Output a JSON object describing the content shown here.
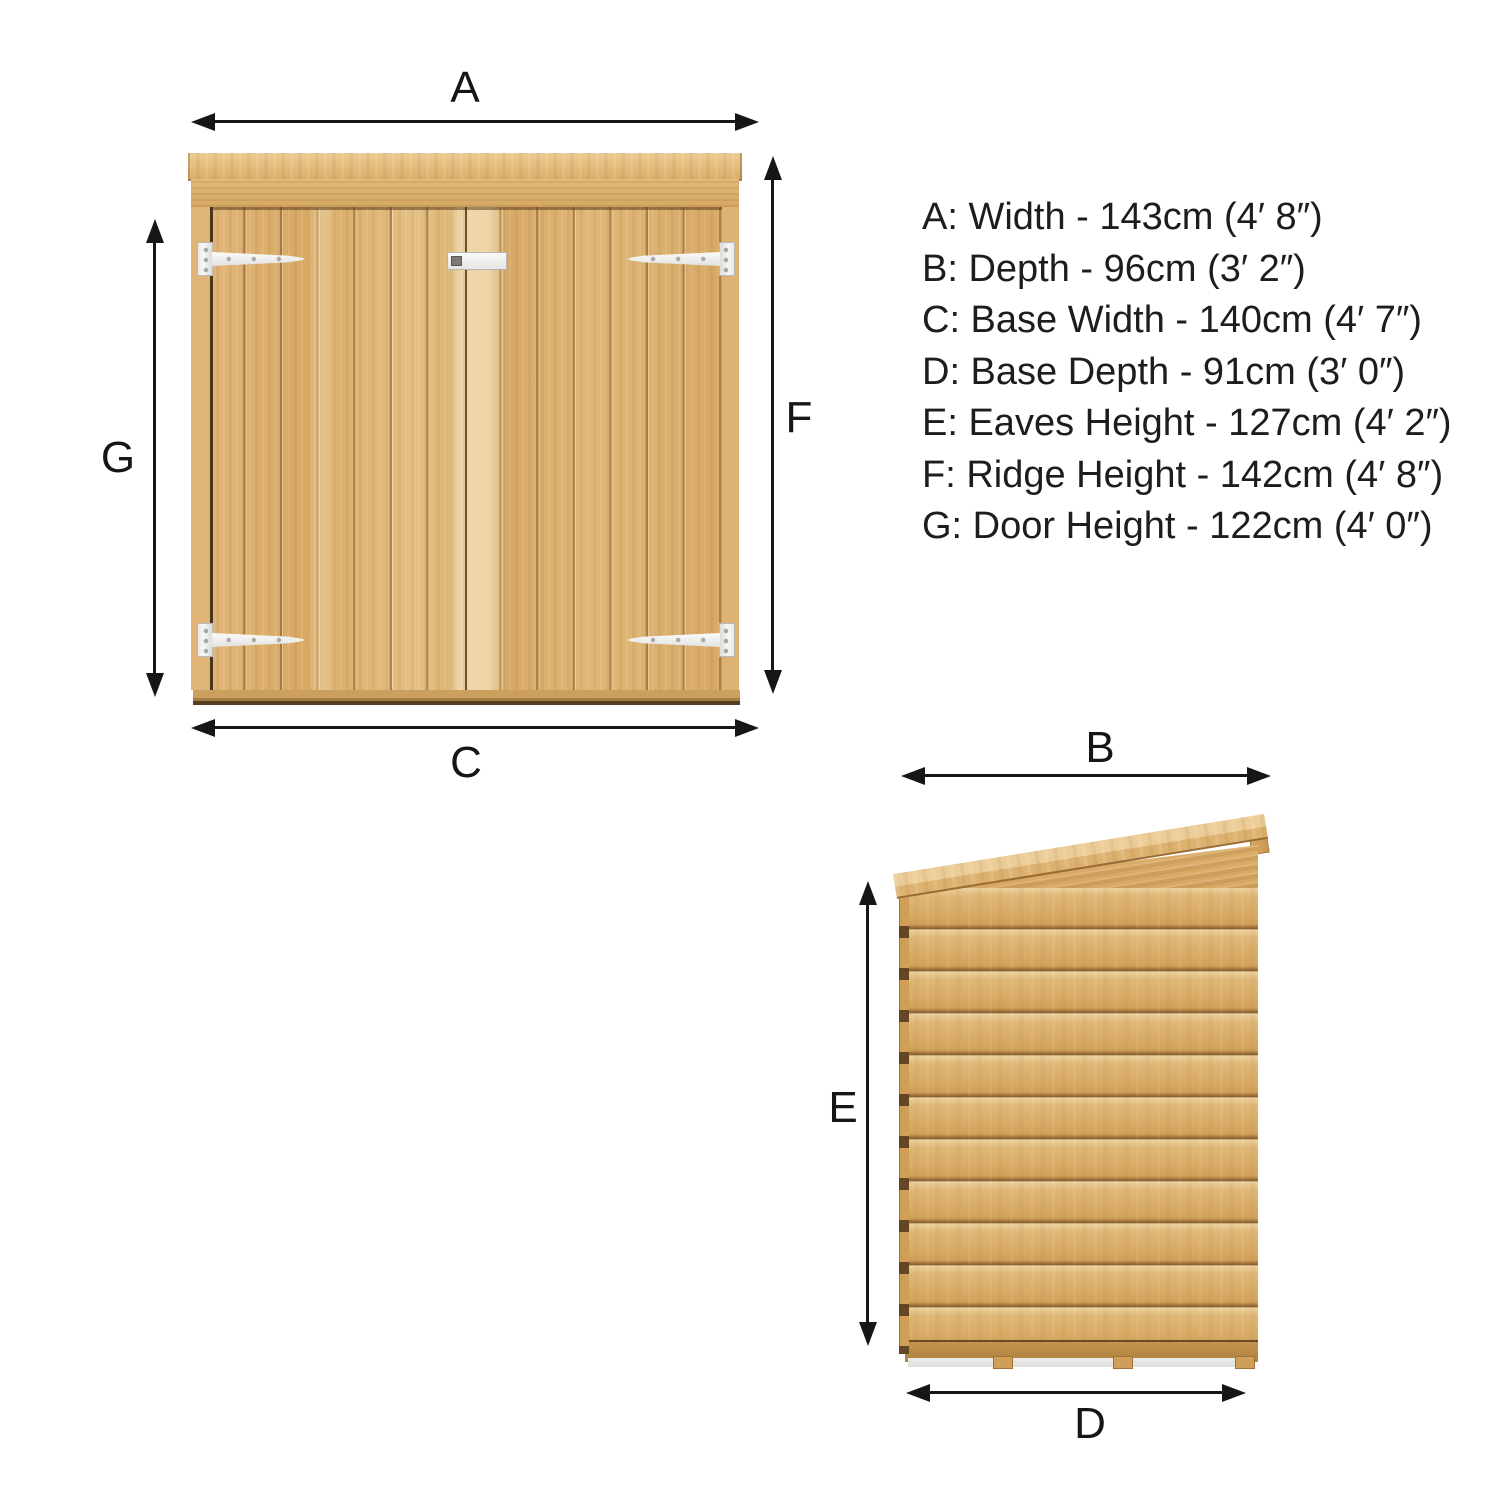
{
  "front_view": {
    "dims": {
      "top": "A",
      "left": "G",
      "right": "F",
      "bottom": "C"
    }
  },
  "side_view": {
    "dims": {
      "top": "B",
      "left": "E",
      "bottom": "D"
    }
  },
  "specs": [
    {
      "id": "A",
      "text": "A: Width - 143cm (4′ 8″)"
    },
    {
      "id": "B",
      "text": "B: Depth - 96cm (3′ 2″)"
    },
    {
      "id": "C",
      "text": "C: Base Width - 140cm (4′ 7″)"
    },
    {
      "id": "D",
      "text": "D: Base Depth - 91cm (3′ 0″)"
    },
    {
      "id": "E",
      "text": "E: Eaves Height - 127cm (4′ 2″)"
    },
    {
      "id": "F",
      "text": "F: Ridge Height - 142cm (4′ 8″)"
    },
    {
      "id": "G",
      "text": "G: Door Height - 122cm (4′ 0″)"
    }
  ],
  "colors": {
    "arrow": "#161616",
    "text": "#1d1d1b",
    "wood_light": "#ecd09c",
    "wood_mid": "#dcb06c",
    "wood_dark": "#8a5f2e",
    "hinge_white": "#f3f3f1",
    "feet_gray": "#e9e9e7"
  }
}
